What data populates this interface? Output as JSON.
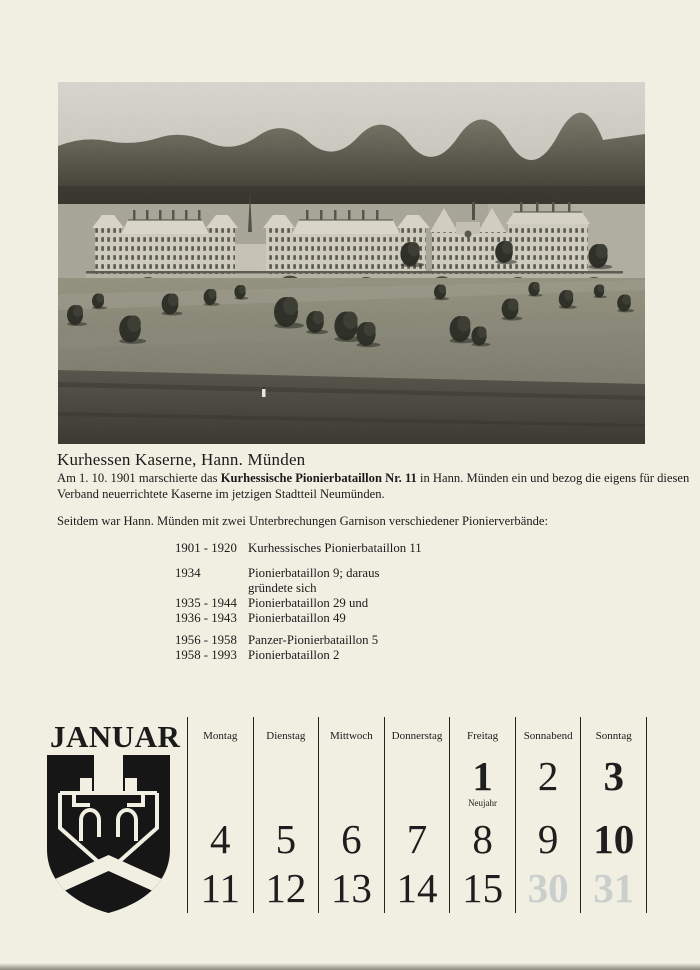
{
  "colors": {
    "paper": "#f0efe2",
    "ink": "#1b1b1b",
    "grid_line": "#26261f",
    "ghost_day": "#8e9aab",
    "photo_sky": "#d0d0c8",
    "photo_forest": "#3c3c34"
  },
  "photo": {
    "name": "kurhessen-kaserne-panorama"
  },
  "caption": {
    "title": "Kurhessen Kaserne, Hann. Münden"
  },
  "history": {
    "para": {
      "prefix": "Am 1. 10. 1901 marschierte das ",
      "bold": "Kurhessische Pionierbataillon Nr. 11",
      "suffix_line1": " in Hann. Münden ein und bezog die eigens für diesen",
      "line2": "Verband neuerrichtete Kaserne im jetzigen Stadtteil Neumünden."
    },
    "garrison_intro": "Seitdem war Hann. Münden mit zwei Unterbrechungen Garnison verschiedener Pionierverbände:",
    "entries": [
      {
        "years": "1901 - 1920",
        "unit": "Kurhessisches Pionierbataillon 11"
      },
      {
        "years": "1934",
        "unit": "Pionierbataillon 9; daraus",
        "unit_cont": "gründete sich"
      },
      {
        "years": "1935 - 1944",
        "unit": "Pionierbataillon 29 und"
      },
      {
        "years": "1936 - 1943",
        "unit": "Pionierbataillon 49"
      },
      {
        "years": "1956 - 1958",
        "unit": "Panzer-Pionierbataillon 5"
      },
      {
        "years": "1958 - 1993",
        "unit": "Pionierbataillon 2"
      }
    ]
  },
  "calendar": {
    "month": "JANUAR",
    "crest_name": "pionier-bridge-crest",
    "weekdays": [
      "Montag",
      "Dienstag",
      "Mittwoch",
      "Donnerstag",
      "Freitag",
      "Sonnabend",
      "Sonntag"
    ],
    "weeks": [
      [
        {
          "day": ""
        },
        {
          "day": ""
        },
        {
          "day": ""
        },
        {
          "day": ""
        },
        {
          "day": "1",
          "note": "Neujahr",
          "bold": true
        },
        {
          "day": "2"
        },
        {
          "day": "3",
          "bold": true
        }
      ],
      [
        {
          "day": "4"
        },
        {
          "day": "5"
        },
        {
          "day": "6"
        },
        {
          "day": "7"
        },
        {
          "day": "8"
        },
        {
          "day": "9"
        },
        {
          "day": "10",
          "bold": true
        }
      ],
      [
        {
          "day": "11"
        },
        {
          "day": "12"
        },
        {
          "day": "13"
        },
        {
          "day": "14"
        },
        {
          "day": "15"
        },
        {
          "day": "30",
          "ghost": true
        },
        {
          "day": "31",
          "ghost": true
        }
      ]
    ]
  }
}
